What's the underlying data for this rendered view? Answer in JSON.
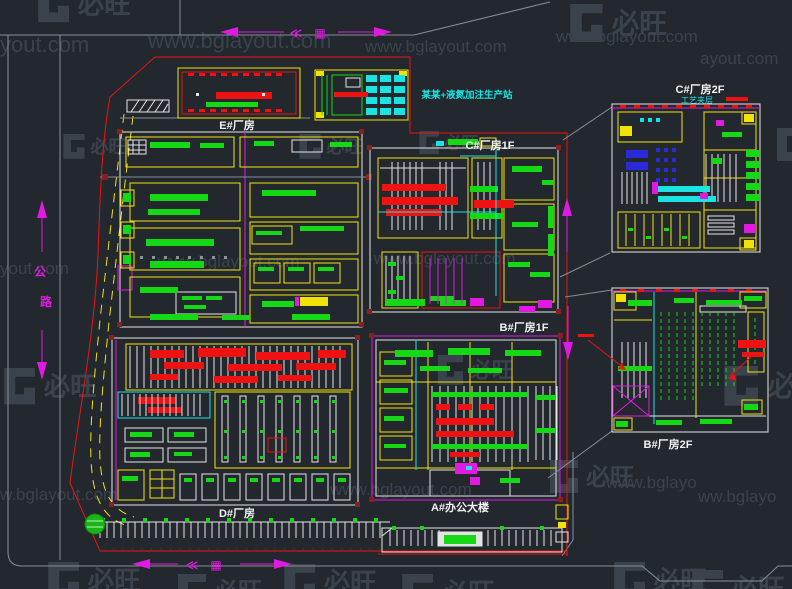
{
  "document": {
    "type": "CAD factory site master plan preview",
    "site": "industrial plant layout with detail callouts"
  },
  "palette": {
    "bg": "#23282f",
    "red": "#ee1212",
    "darkred": "#8b1f1f",
    "yellow": "#f2e20a",
    "green": "#16d916",
    "cyan": "#1ce2e2",
    "magenta": "#e219e2",
    "white": "#e4e4e4",
    "blue": "#2a2ad9",
    "gray": "#878e96",
    "label": "#f2f2f2",
    "wm": "#3a424c"
  },
  "watermarks": {
    "brand": "必旺",
    "url": "www.bglayout.com",
    "url_short": "yout.com",
    "url_tail": "ayout.com",
    "url_partial": "www.bglayo",
    "url_partial2": "ww.bglayo",
    "url_partial3": "w.bglayout.com",
    "url_mid": "·www.bglayout.com"
  },
  "labels": {
    "building_e": "E#厂房",
    "building_c1": "C#厂房1F",
    "building_b1": "B#厂房1F",
    "building_a": "A#办公大楼",
    "building_d": "D#厂房",
    "building_c2": "C#厂房2F",
    "building_b2": "B#厂房2F",
    "station_note": "某某+液氮加注生产站",
    "mezzanine_note": "工艺夹层",
    "road_char_top": "公",
    "road_char_bottom": "路",
    "dir_glyph_a": "≪",
    "dir_glyph_b": "▦"
  }
}
